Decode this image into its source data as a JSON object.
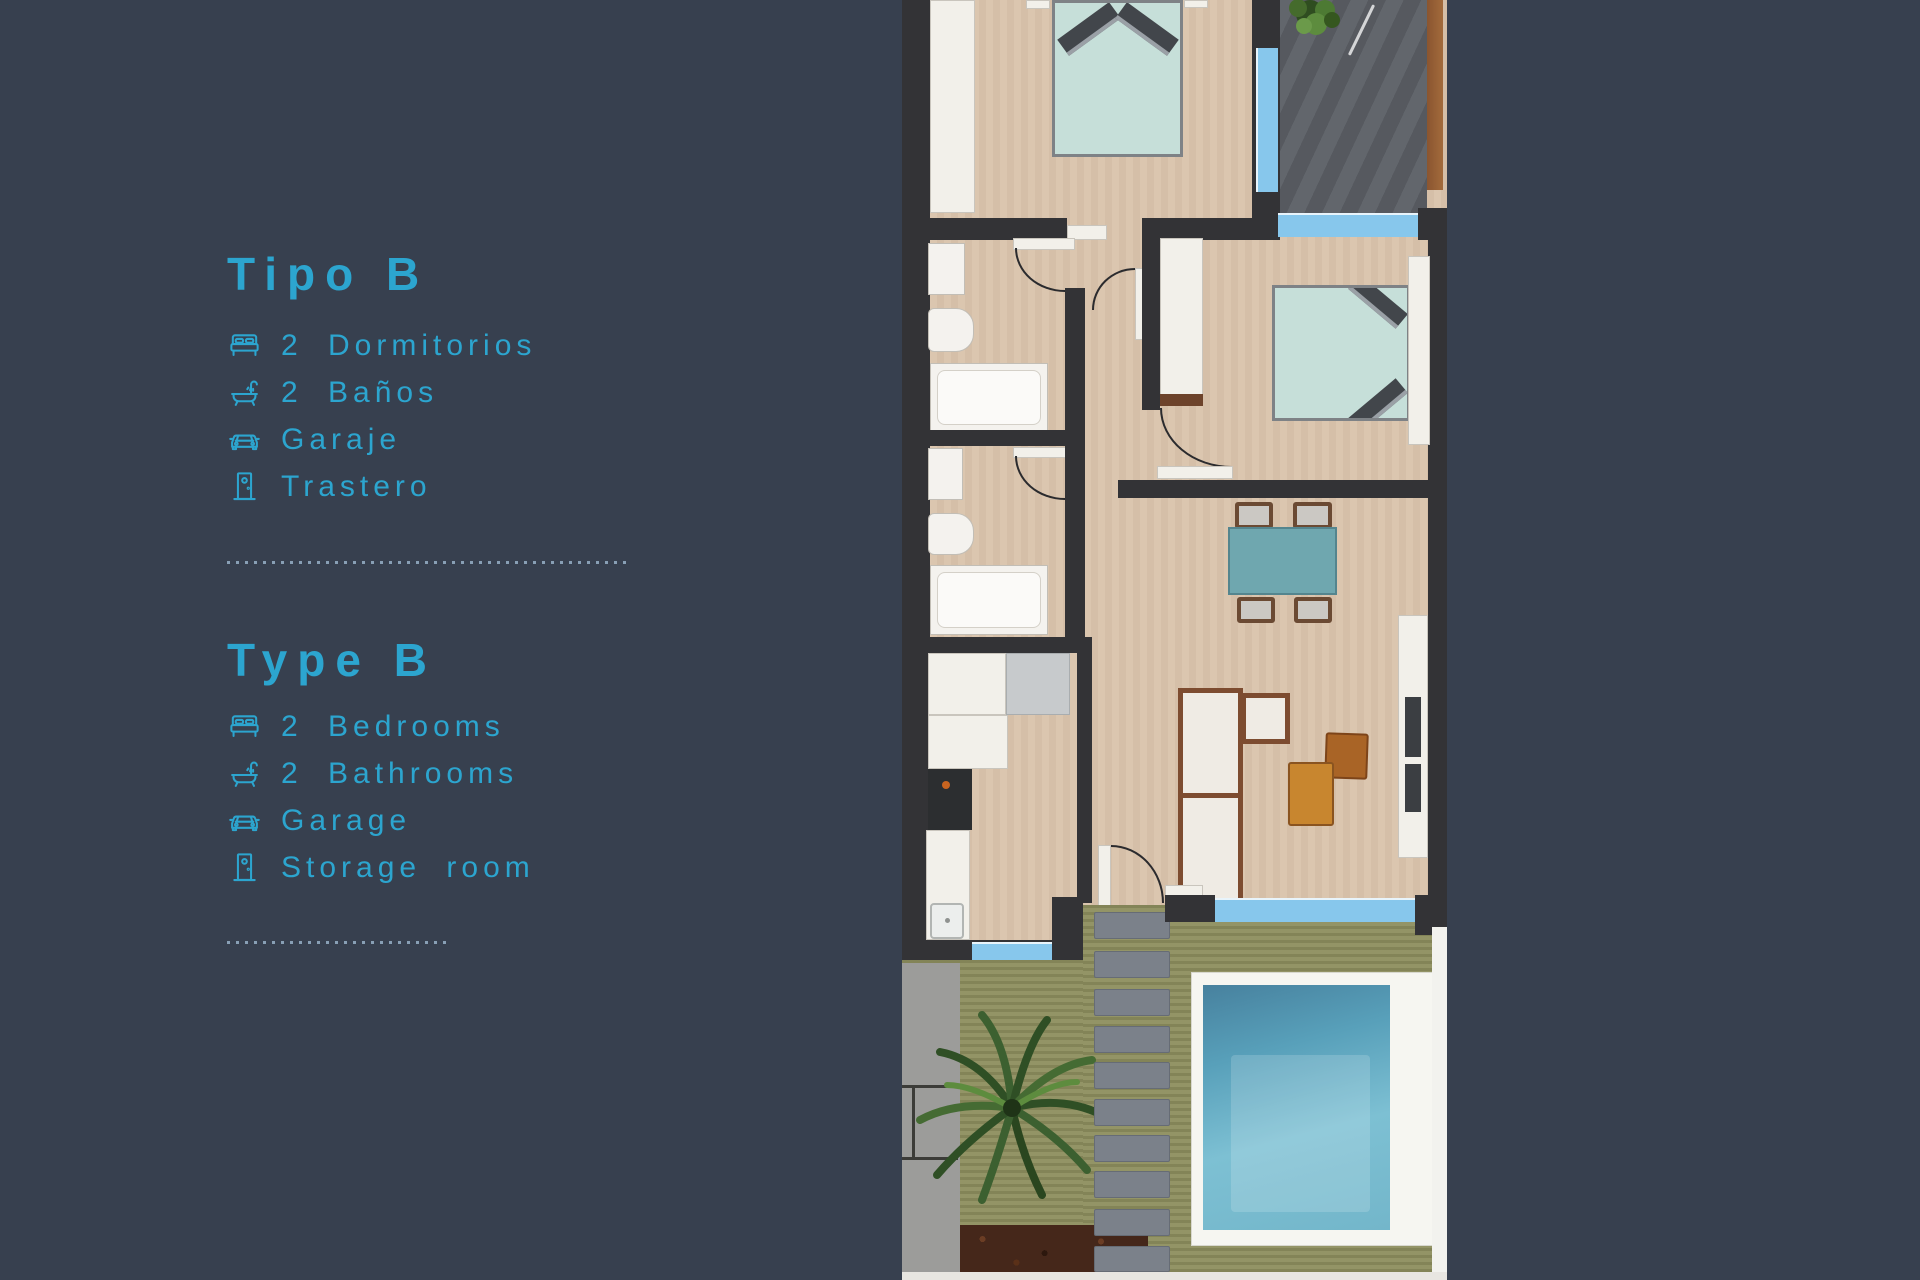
{
  "panel": {
    "es": {
      "title": "Tipo B",
      "features": [
        {
          "icon": "bed-icon",
          "label": "2 Dormitorios"
        },
        {
          "icon": "bath-icon",
          "label": "2 Baños"
        },
        {
          "icon": "car-icon",
          "label": "Garaje"
        },
        {
          "icon": "door-icon",
          "label": "Trastero"
        }
      ]
    },
    "en": {
      "title": "Type B",
      "features": [
        {
          "icon": "bed-icon",
          "label": "2 Bedrooms"
        },
        {
          "icon": "bath-icon",
          "label": "2 Bathrooms"
        },
        {
          "icon": "car-icon",
          "label": "Garage"
        },
        {
          "icon": "door-icon",
          "label": "Storage room"
        }
      ]
    }
  },
  "palette": {
    "background_navy": "#37404f",
    "accent_cyan": "#2ca5cf",
    "divider_dots": "#96b0c7",
    "plan_floor_beige": "#d9c3ab",
    "plan_wall_dark": "#333336",
    "window_blue": "#87c7ec",
    "bed_teal": "#c6dfd9",
    "table_teal": "#6fa7af",
    "terrace_gray": "#5c6066",
    "grass_olive": "#8d8e5e",
    "pool_water_blue": "#5aa0ba",
    "pool_deck_white": "#f6f6f1",
    "wood_orange": "#c8862f"
  }
}
